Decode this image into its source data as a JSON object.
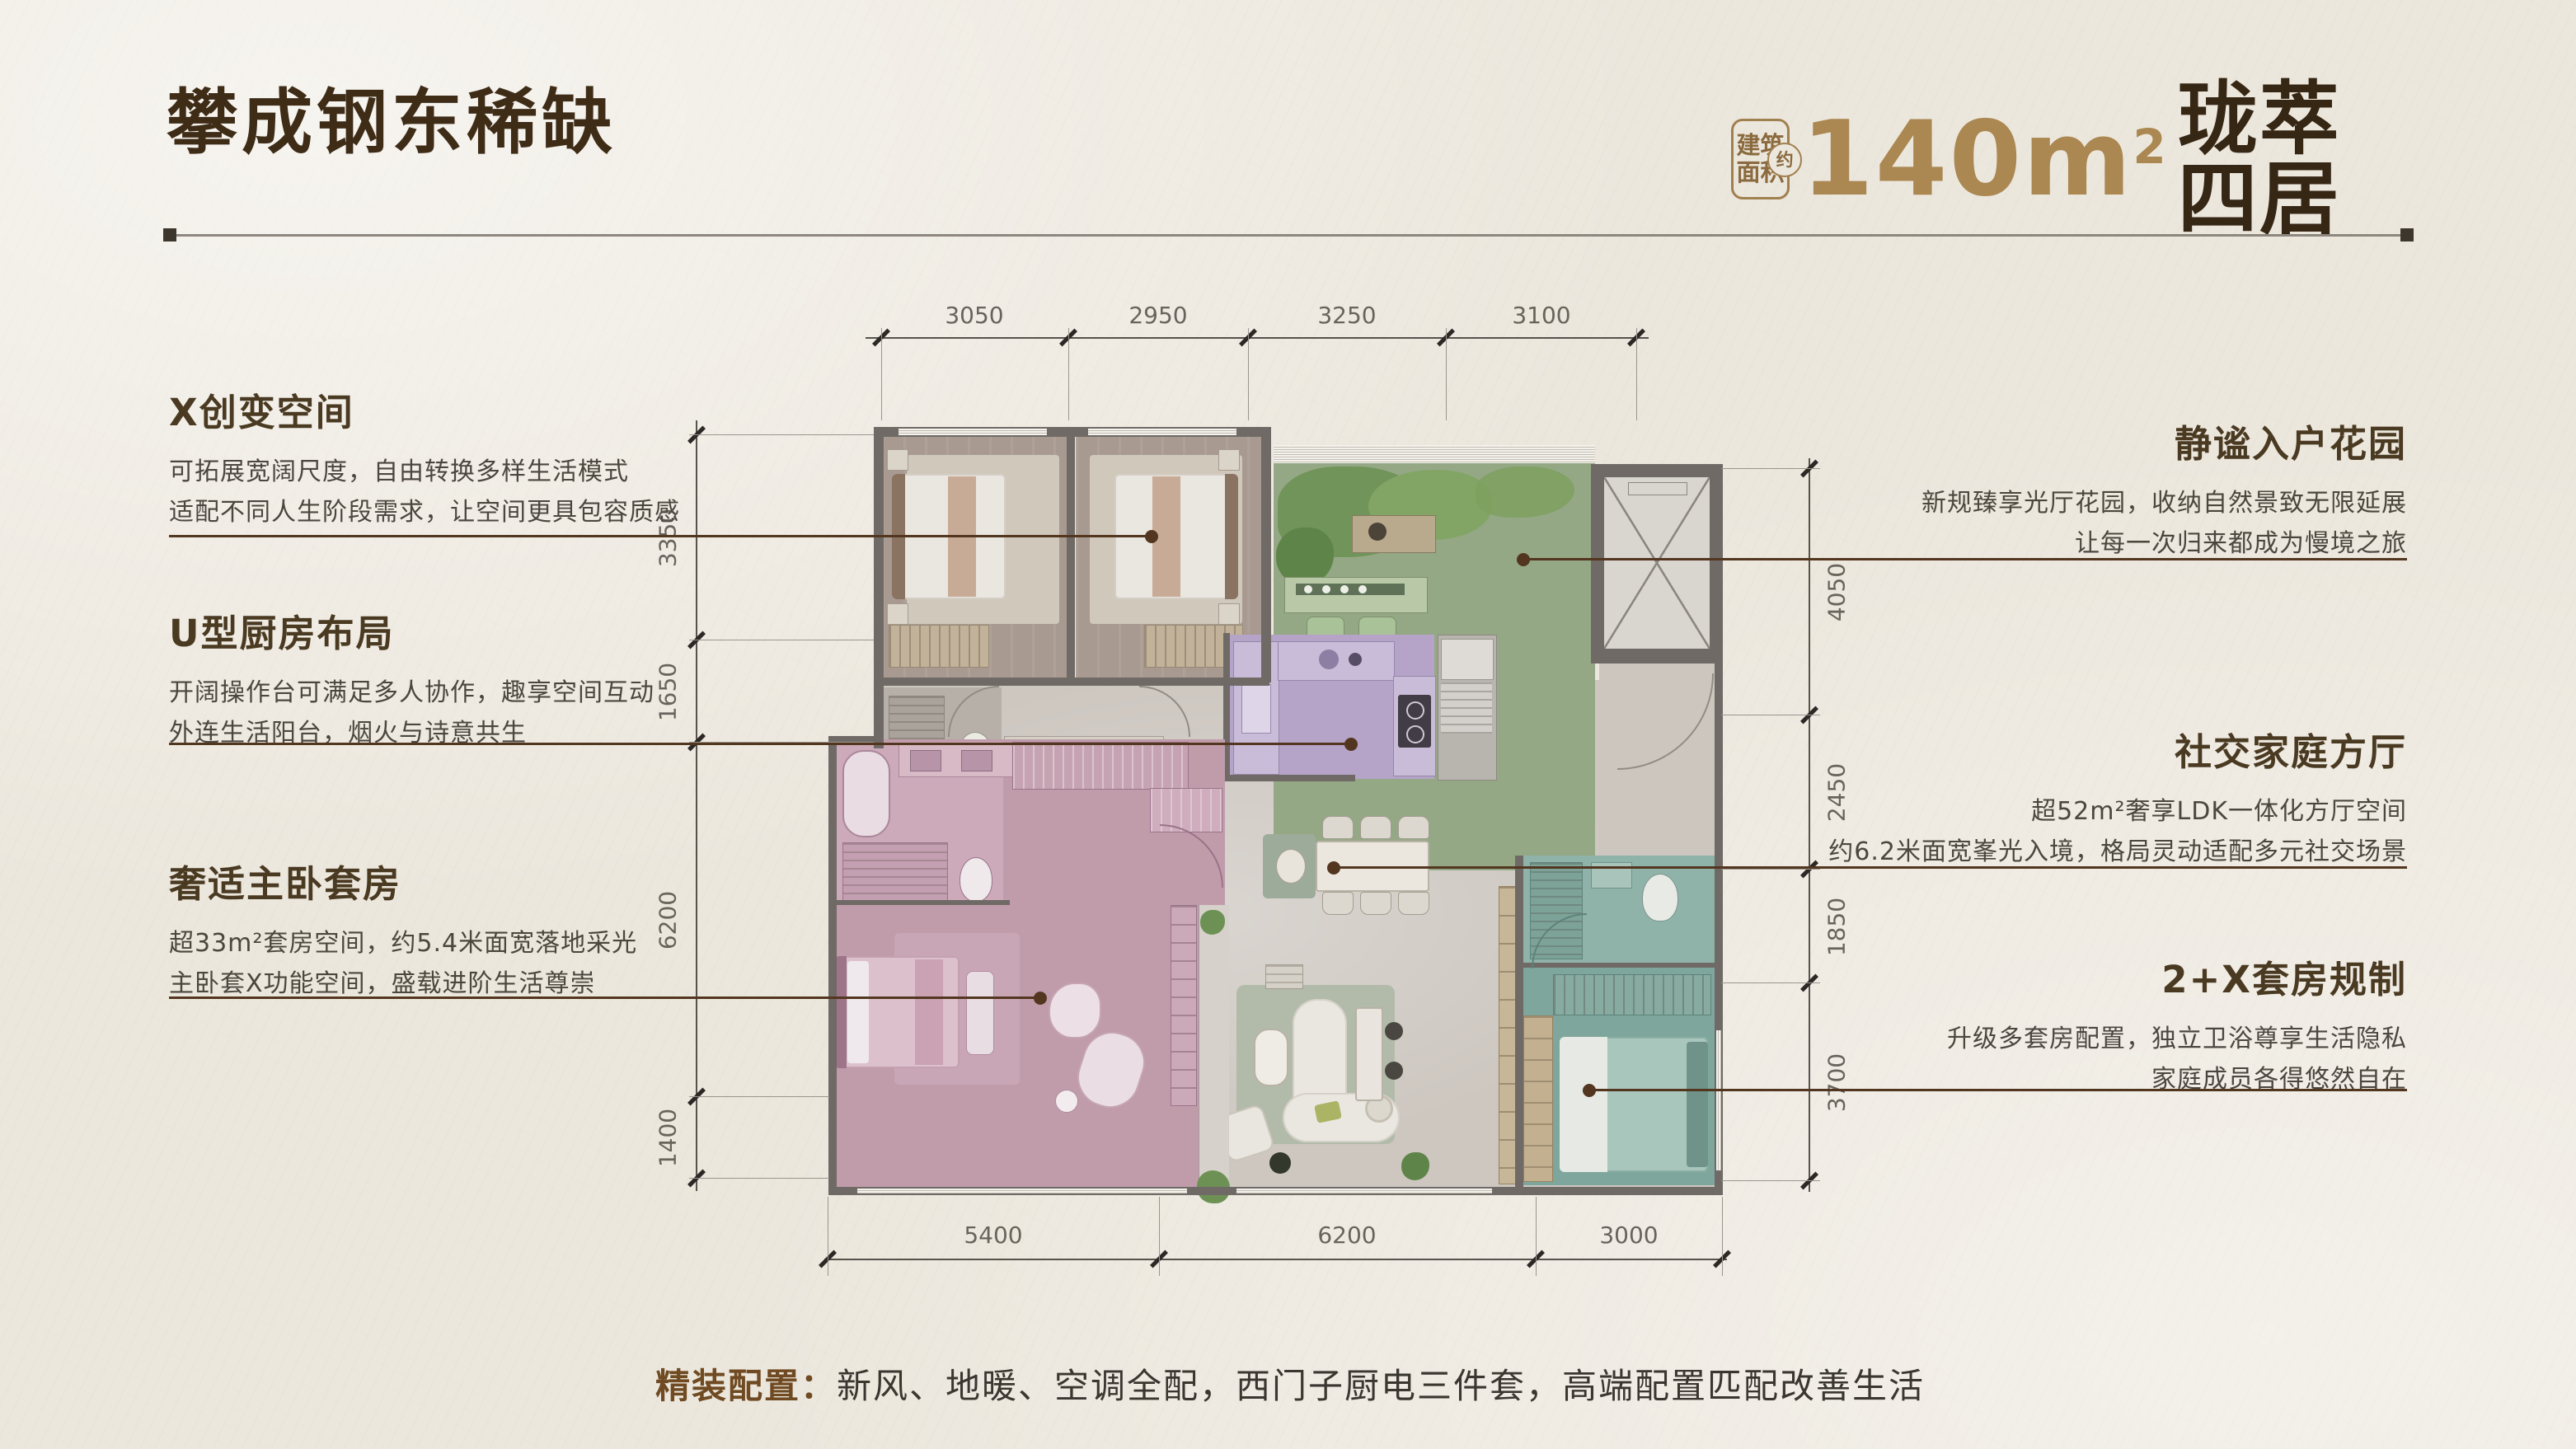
{
  "page": {
    "title": "攀成钢东稀缺",
    "area_badge": {
      "line1": "建筑",
      "line2": "面积",
      "approx": "约"
    },
    "area": {
      "value": "140m",
      "sup": "2",
      "suffix": "珑萃四居"
    },
    "footer": {
      "label": "精装配置：",
      "text": "新风、地暖、空调全配，西门子厨电三件套，高端配置匹配改善生活"
    }
  },
  "callouts": {
    "left": [
      {
        "title": "X创变空间",
        "lines": [
          "可拓展宽阔尺度，自由转换多样生活模式",
          "适配不同人生阶段需求，让空间更具包容质感"
        ]
      },
      {
        "title": "U型厨房布局",
        "lines": [
          "开阔操作台可满足多人协作，趣享空间互动",
          "外连生活阳台，烟火与诗意共生"
        ]
      },
      {
        "title": "奢适主卧套房",
        "lines": [
          "超33m²套房空间，约5.4米面宽落地采光",
          "主卧套X功能空间，盛载进阶生活尊崇"
        ]
      }
    ],
    "right": [
      {
        "title": "静谧入户花园",
        "lines": [
          "新规臻享光厅花园，收纳自然景致无限延展",
          "让每一次归来都成为慢境之旅"
        ]
      },
      {
        "title": "社交家庭方厅",
        "lines": [
          "超52m²奢享LDK一体化方厅空间",
          "约6.2米面宽峯光入境，格局灵动适配多元社交场景"
        ]
      },
      {
        "title": "2+X套房规制",
        "lines": [
          "升级多套房配置，独立卫浴尊享生活隐私",
          "家庭成员各得悠然自在"
        ]
      }
    ]
  },
  "dimensions": {
    "top": [
      "3050",
      "2950",
      "3250",
      "3100"
    ],
    "left": [
      "3350",
      "1650",
      "6200",
      "1400"
    ],
    "right": [
      "4050",
      "2450",
      "1850",
      "3700"
    ],
    "bottom": [
      "5400",
      "6200",
      "3000"
    ]
  },
  "colors": {
    "background": "#ece7dd",
    "title_brown": "#3e2c17",
    "gold_accent": "#ab8751",
    "leader_brown": "#53361f",
    "wall_gray": "#6f6a65",
    "ldk_floor_gray": "#cdc7c0",
    "bedroom_wood": "#a89a90",
    "garden_green": "#95a886",
    "kitchen_purple": "#b5a4c8",
    "master_pink": "#c09cab",
    "suite_teal": "#7ea69c"
  }
}
